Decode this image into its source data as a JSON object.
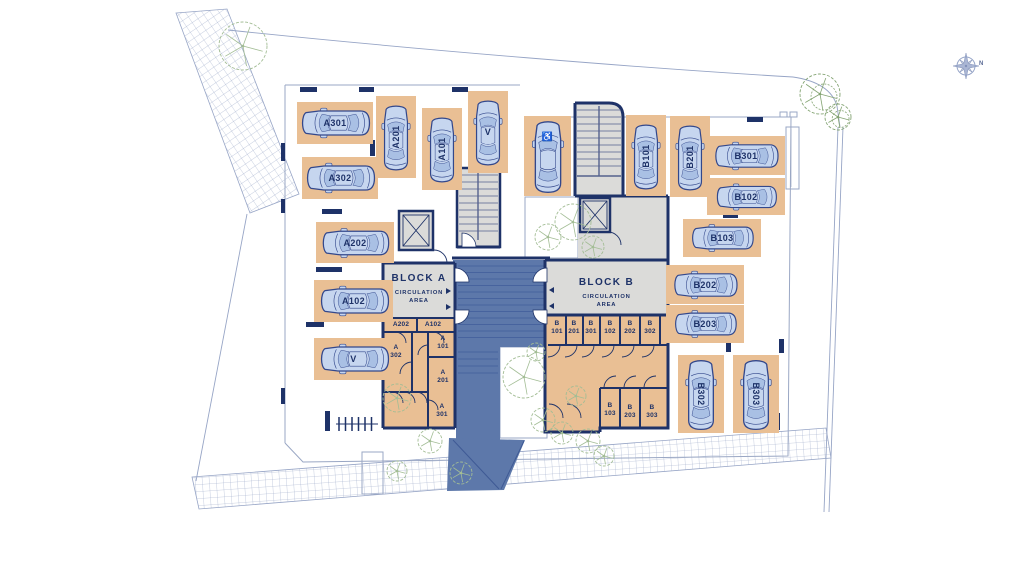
{
  "title": "Residential site plan — parking level, Block A and Block B",
  "compass": {
    "label": "N"
  },
  "colors": {
    "wall_navy": "#1e3268",
    "parking_tan": "#e9bf94",
    "car_fill": "#c6d6ef",
    "car_shade": "#a9c0e4",
    "car_stroke": "#33488c",
    "circulation_gray": "#dbdbd9",
    "ramp_blue": "#5d78aa",
    "tread_blue": "#47639e",
    "tree_green": "#a3bd95",
    "tree_dark": "#84a473",
    "line_blue": "#97a5c6"
  },
  "block_a": {
    "name": "BLOCK A",
    "area_line1": "CIRCULATION",
    "area_line2": "AREA"
  },
  "block_b": {
    "name": "BLOCK B",
    "area_line1": "CIRCULATION",
    "area_line2": "AREA"
  },
  "parking_spaces": [
    {
      "label": "A301",
      "x": 297,
      "y": 102,
      "w": 76,
      "h": 42,
      "orient": "h",
      "label_dir": "none",
      "type": "standard"
    },
    {
      "label": "A302",
      "x": 302,
      "y": 157,
      "w": 76,
      "h": 42,
      "orient": "h",
      "label_dir": "none",
      "type": "standard"
    },
    {
      "label": "A201",
      "x": 376,
      "y": 96,
      "w": 40,
      "h": 82,
      "orient": "v",
      "label_dir": "up",
      "type": "standard"
    },
    {
      "label": "A101",
      "x": 422,
      "y": 108,
      "w": 40,
      "h": 82,
      "orient": "v",
      "label_dir": "up",
      "type": "standard"
    },
    {
      "label": "V",
      "x": 468,
      "y": 91,
      "w": 40,
      "h": 82,
      "orient": "v",
      "label_dir": "none",
      "type": "visitor"
    },
    {
      "label": "A202",
      "x": 316,
      "y": 222,
      "w": 78,
      "h": 41,
      "orient": "h",
      "label_dir": "none",
      "type": "standard"
    },
    {
      "label": "A102",
      "x": 314,
      "y": 280,
      "w": 79,
      "h": 42,
      "orient": "h",
      "label_dir": "none",
      "type": "standard"
    },
    {
      "label": "V",
      "x": 314,
      "y": 338,
      "w": 79,
      "h": 42,
      "orient": "h",
      "label_dir": "none",
      "type": "visitor"
    },
    {
      "label": "",
      "x": 524,
      "y": 116,
      "w": 47,
      "h": 80,
      "orient": "v",
      "label_dir": "none",
      "type": "accessible"
    },
    {
      "label": "B101",
      "x": 626,
      "y": 115,
      "w": 40,
      "h": 81,
      "orient": "v",
      "label_dir": "up",
      "type": "standard"
    },
    {
      "label": "B201",
      "x": 670,
      "y": 116,
      "w": 40,
      "h": 81,
      "orient": "v",
      "label_dir": "up",
      "type": "standard"
    },
    {
      "label": "B301",
      "x": 707,
      "y": 136,
      "w": 78,
      "h": 39,
      "orient": "h",
      "label_dir": "none",
      "type": "standard"
    },
    {
      "label": "B102",
      "x": 707,
      "y": 178,
      "w": 78,
      "h": 37,
      "orient": "h",
      "label_dir": "none",
      "type": "standard"
    },
    {
      "label": "B103",
      "x": 683,
      "y": 219,
      "w": 78,
      "h": 38,
      "orient": "h",
      "label_dir": "none",
      "type": "standard"
    },
    {
      "label": "B202",
      "x": 666,
      "y": 265,
      "w": 78,
      "h": 39,
      "orient": "h",
      "label_dir": "none",
      "type": "standard"
    },
    {
      "label": "B203",
      "x": 666,
      "y": 305,
      "w": 78,
      "h": 38,
      "orient": "h",
      "label_dir": "none",
      "type": "standard"
    },
    {
      "label": "B302",
      "x": 678,
      "y": 355,
      "w": 46,
      "h": 78,
      "orient": "v",
      "label_dir": "down",
      "type": "standard"
    },
    {
      "label": "B303",
      "x": 733,
      "y": 355,
      "w": 46,
      "h": 78,
      "orient": "v",
      "label_dir": "down",
      "type": "standard"
    }
  ],
  "storage_rooms": {
    "a": [
      {
        "lines": [
          "A202"
        ],
        "x": 401,
        "y": 321
      },
      {
        "lines": [
          "A102"
        ],
        "x": 433,
        "y": 321
      },
      {
        "lines": [
          "A",
          "302"
        ],
        "x": 396,
        "y": 344
      },
      {
        "lines": [
          "A",
          "101"
        ],
        "x": 443,
        "y": 335
      },
      {
        "lines": [
          "A",
          "201"
        ],
        "x": 443,
        "y": 369
      },
      {
        "lines": [
          "A",
          "301"
        ],
        "x": 442,
        "y": 403
      }
    ],
    "b": [
      {
        "lines": [
          "B",
          "101"
        ],
        "x": 557,
        "y": 320
      },
      {
        "lines": [
          "B",
          "201"
        ],
        "x": 574,
        "y": 320
      },
      {
        "lines": [
          "B",
          "301"
        ],
        "x": 591,
        "y": 320
      },
      {
        "lines": [
          "B",
          "102"
        ],
        "x": 610,
        "y": 320
      },
      {
        "lines": [
          "B",
          "202"
        ],
        "x": 630,
        "y": 320
      },
      {
        "lines": [
          "B",
          "302"
        ],
        "x": 650,
        "y": 320
      },
      {
        "lines": [
          "B",
          "103"
        ],
        "x": 610,
        "y": 402
      },
      {
        "lines": [
          "B",
          "203"
        ],
        "x": 630,
        "y": 404
      },
      {
        "lines": [
          "B",
          "303"
        ],
        "x": 652,
        "y": 404
      }
    ]
  },
  "site": {
    "trees": [
      {
        "x": 243,
        "y": 46,
        "r": 24,
        "tone": "light"
      },
      {
        "x": 820,
        "y": 94,
        "r": 20,
        "tone": "dark"
      },
      {
        "x": 838,
        "y": 117,
        "r": 13,
        "tone": "dark"
      },
      {
        "x": 548,
        "y": 237,
        "r": 13,
        "tone": "light"
      },
      {
        "x": 573,
        "y": 222,
        "r": 18,
        "tone": "light"
      },
      {
        "x": 593,
        "y": 247,
        "r": 11,
        "tone": "light"
      },
      {
        "x": 524,
        "y": 377,
        "r": 21,
        "tone": "light"
      },
      {
        "x": 536,
        "y": 352,
        "r": 9,
        "tone": "light"
      },
      {
        "x": 576,
        "y": 396,
        "r": 10,
        "tone": "light"
      },
      {
        "x": 543,
        "y": 420,
        "r": 12,
        "tone": "light"
      },
      {
        "x": 562,
        "y": 433,
        "r": 11,
        "tone": "light"
      },
      {
        "x": 588,
        "y": 441,
        "r": 12,
        "tone": "light"
      },
      {
        "x": 604,
        "y": 456,
        "r": 10,
        "tone": "light"
      },
      {
        "x": 397,
        "y": 398,
        "r": 14,
        "tone": "light"
      },
      {
        "x": 430,
        "y": 441,
        "r": 12,
        "tone": "light"
      },
      {
        "x": 397,
        "y": 471,
        "r": 10,
        "tone": "light"
      },
      {
        "x": 461,
        "y": 473,
        "r": 11,
        "tone": "light"
      }
    ]
  }
}
